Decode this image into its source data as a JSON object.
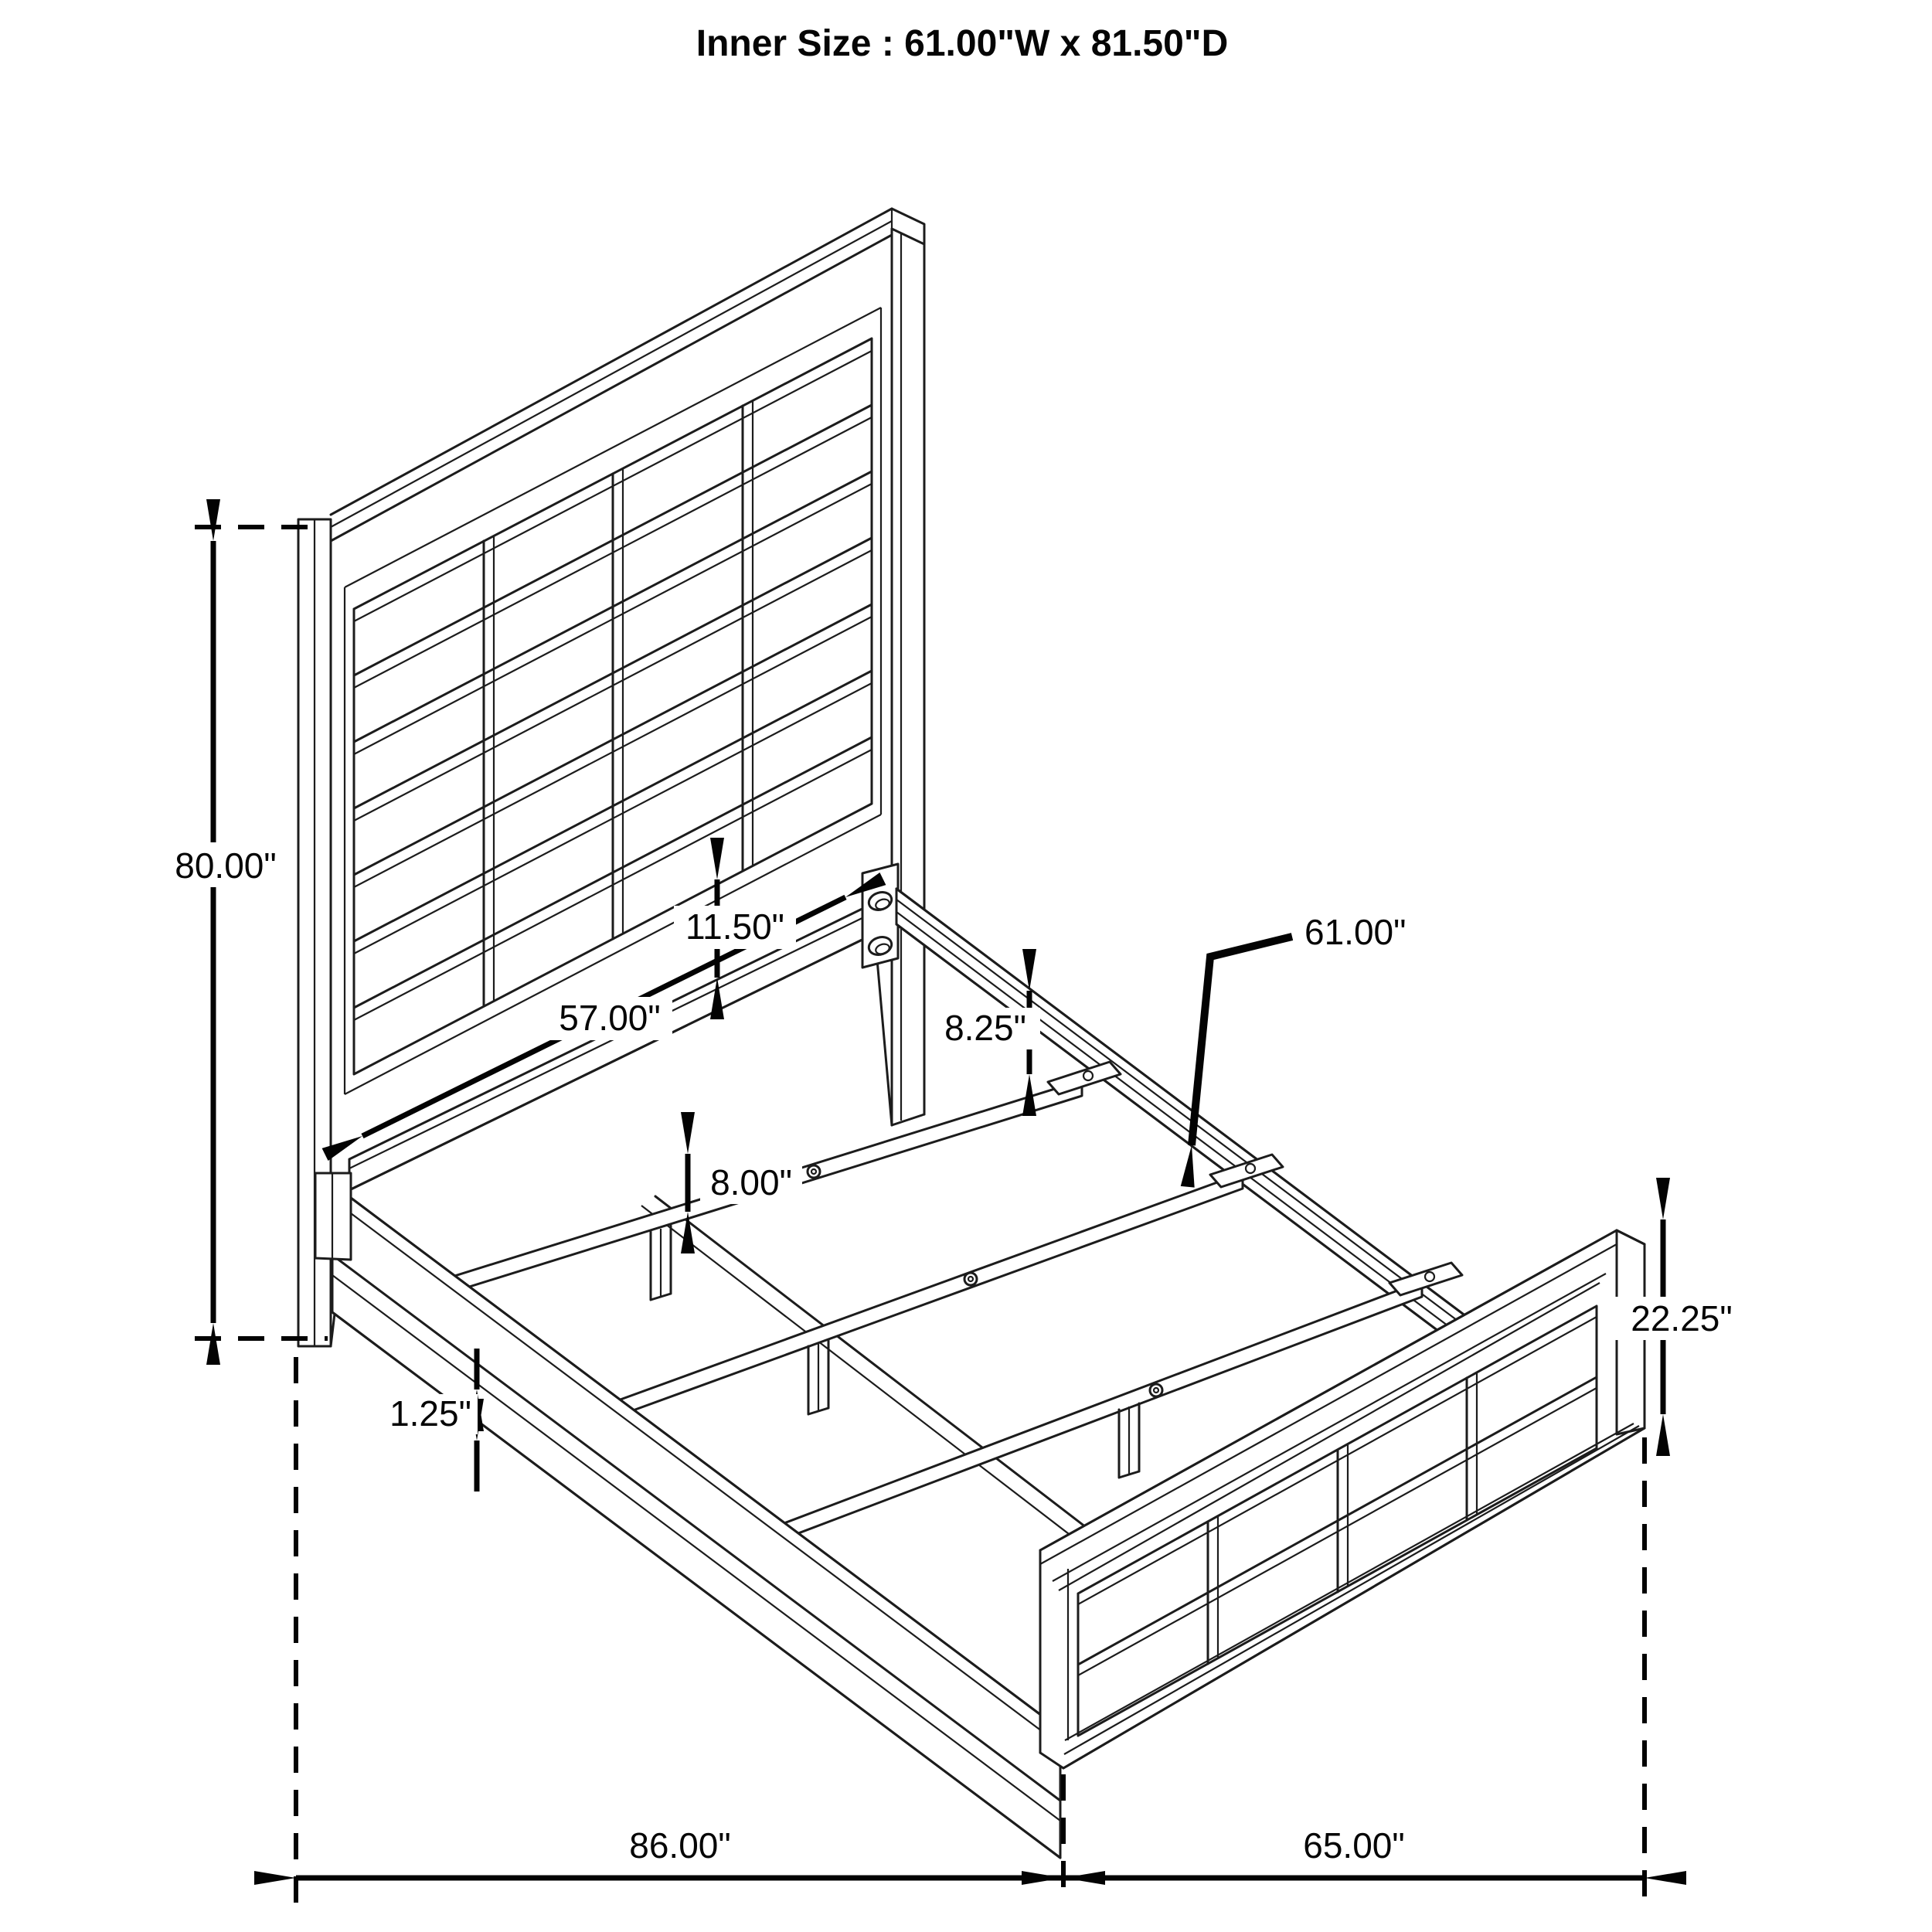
{
  "title": "Inner Size : 61.00\"W x 81.50\"D",
  "diagram": "bed-frame-dimension-drawing",
  "colors": {
    "line": "#1c1c1c",
    "dimension": "#030303",
    "background": "#ffffff"
  },
  "dimensions": {
    "headboard_height": {
      "label": "80.00\"",
      "meaning": "overall headboard height"
    },
    "headboard_inner_width": {
      "label": "57.00\"",
      "meaning": "width between headboard posts"
    },
    "panel_gap": {
      "label": "11.50\"",
      "meaning": "gap below upholstered panel"
    },
    "center_leg_height": {
      "label": "8.00\"",
      "meaning": "center support leg height"
    },
    "rail_to_slat": {
      "label": "8.25\"",
      "meaning": "side rail top to slat"
    },
    "slat_length": {
      "label": "61.00\"",
      "meaning": "slat length / inner width"
    },
    "rail_thickness": {
      "label": "1.25\"",
      "meaning": "side rail board thickness"
    },
    "footboard_height": {
      "label": "22.25\"",
      "meaning": "footboard height"
    },
    "overall_length": {
      "label": "86.00\"",
      "meaning": "headboard to footboard length"
    },
    "footboard_span": {
      "label": "65.00\"",
      "meaning": "footboard width span"
    }
  }
}
